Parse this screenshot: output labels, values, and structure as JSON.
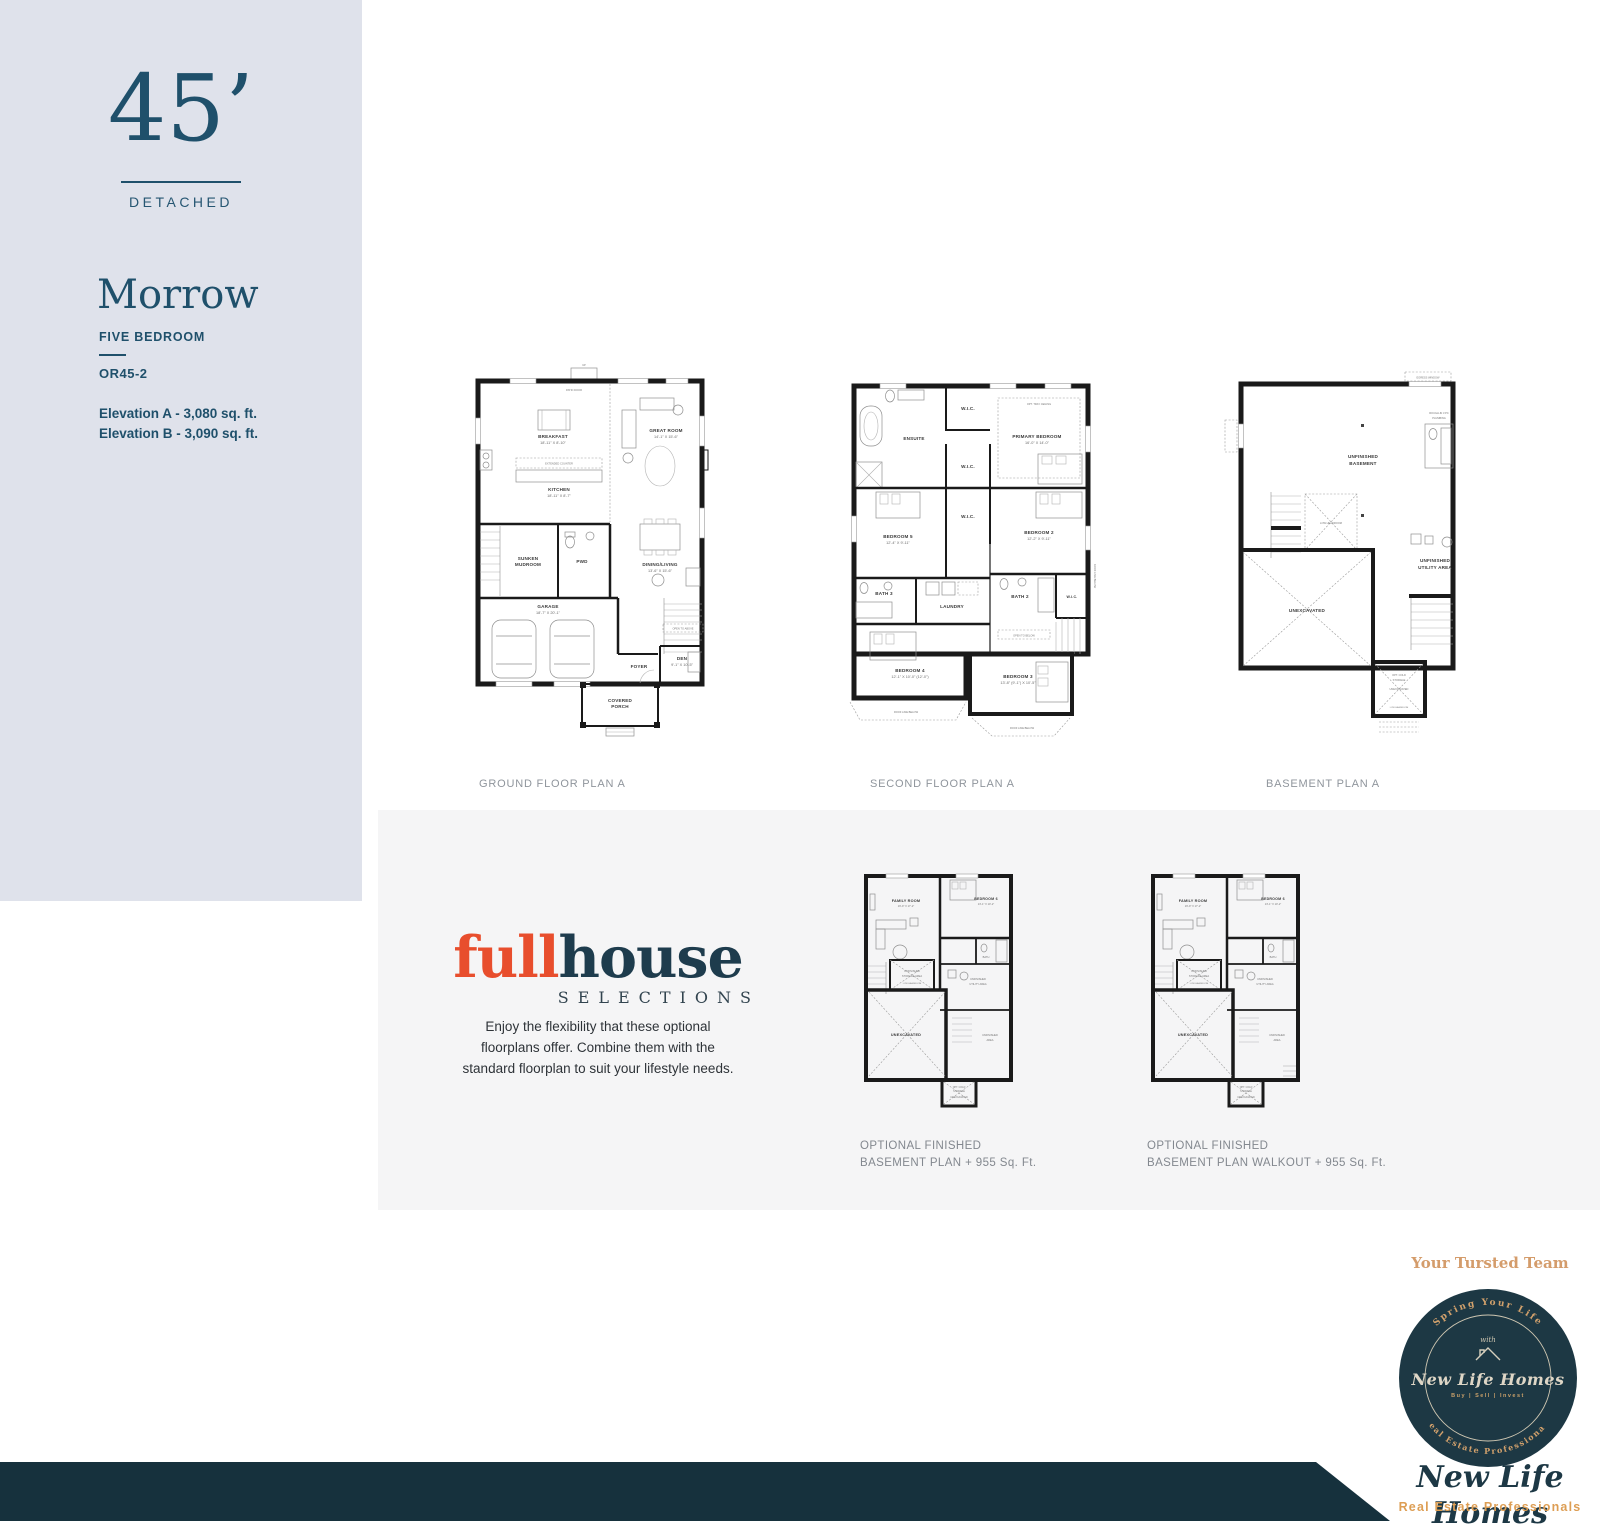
{
  "sidebar": {
    "frontage": "45’",
    "type": "DETACHED",
    "model": "Morrow",
    "bedrooms": "FIVE BEDROOM",
    "code": "OR45-2",
    "elevation_a": "Elevation A - 3,080 sq. ft.",
    "elevation_b": "Elevation B - 3,090 sq. ft.",
    "bg_color": "#dfe2eb",
    "accent_color": "#1f506b"
  },
  "captions": {
    "ground": "GROUND FLOOR PLAN A",
    "second": "SECOND FLOOR PLAN A",
    "basement": "BASEMENT PLAN A",
    "optional_left": [
      "OPTIONAL FINISHED",
      "BASEMENT PLAN + 955 Sq. Ft."
    ],
    "optional_right": [
      "OPTIONAL FINISHED",
      "BASEMENT PLAN WALKOUT + 955 Sq. Ft."
    ]
  },
  "ground": {
    "up": "UP",
    "patio_door": "PATIO DOOR",
    "breakfast": "BREAKFAST",
    "breakfast_dim": "18'-11\" X 8'-10\"",
    "kitchen": "KITCHEN",
    "kitchen_dim": "18'-11\" X 8'-7\"",
    "extended_counter": "EXTENDED COUNTER",
    "great_room": "GREAT ROOM",
    "great_room_dim": "14'-1\" X 15'-6\"",
    "sunken": "SUNKEN",
    "mudroom": "MUDROOM",
    "pwd": "PWD",
    "dining": "DINING/LIVING",
    "dining_dim": "13'-6\" X 15'-6\"",
    "garage": "GARAGE",
    "garage_dim": "18'-7\" X 20'-1\"",
    "open_above": "OPEN TO ABOVE",
    "foyer": "FOYER",
    "den": "DEN",
    "den_dim": "9'-1\" X 10'-5\"",
    "covered": "COVERED",
    "porch": "PORCH"
  },
  "second": {
    "ensuite": "ENSUITE",
    "wic": "W.I.C.",
    "primary": "PRIMARY BEDROOM",
    "primary_dim": "16'-0\" X 14'-0\"",
    "tray": "OPT. TRAY CEILING",
    "bedroom5": "BEDROOM 5",
    "bedroom5_dim": "12'-4\" X 9'-11\"",
    "bedroom2": "BEDROOM 2",
    "bedroom2_dim": "12'-2\" X 9'-11\"",
    "bath3": "BATH 3",
    "laundry": "LAUNDRY",
    "bath2": "BATH 2",
    "bedroom4": "BEDROOM 4",
    "bedroom4_dim": "12'-1\" X 10'-0\" (12'-0\")",
    "bedroom3": "BEDROOM 3",
    "bedroom3_dim": "13'-8\" (9'-1\") X 10'-5\"",
    "open_below": "OPEN TO BELOW",
    "roof_line": "ROOF LINE BELOW"
  },
  "basement": {
    "egress": "EGRESS WINDOW",
    "unfinished": "UNFINISHED",
    "basement_word": "BASEMENT",
    "low_headroom": "LOW HEADROOM",
    "unexcavated": "UNEXCAVATED",
    "utility_1": "UNFINISHED",
    "utility_2": "UTILITY AREA",
    "rough_in_1": "ROUGH-IN 3 PC",
    "rough_in_2": "PLUMBING",
    "cold_1": "OPT. COLD",
    "cold_2": "STORAGE"
  },
  "optional": {
    "family": "FAMILY ROOM",
    "family_dim": "16'-9\" X 17'-2\"",
    "bedroom6": "BEDROOM 6",
    "bedroom6_dim": "13'-1\" X 10'-2\"",
    "bath": "BATH",
    "storage_1": "UNFINISHED",
    "storage_2": "STORAGE AREA",
    "low_headroom": "LOW HEADROOM",
    "unexcavated": "UNEXCAVATED",
    "utility_1": "UNFINISHED",
    "utility_2": "UTILITY AREA",
    "area_1": "UNFINISHED",
    "area_2": "AREA",
    "cold_1": "OPT. COLD",
    "cold_2": "STORAGE"
  },
  "fullhouse": {
    "word_full": "full",
    "word_house": "house",
    "subtitle": "SELECTIONS",
    "description": [
      "Enjoy the flexibility that these optional",
      "floorplans offer. Combine them with the",
      "standard floorplan to suit your lifestyle needs."
    ],
    "color_full": "#e84e2d",
    "color_house": "#1e3c4d"
  },
  "branding": {
    "tagline": "Your Tursted Team",
    "arc_top": "Spring Your Life",
    "with_word": "with",
    "badge_name": "New Life Homes",
    "badge_services": "Buy | Sell | Invest",
    "arc_bottom": "Real Estate Professionals",
    "signature": "New Life Homes",
    "signature_sub": "Real Estate Professionals",
    "colors": {
      "badge_bg": "#1d3844",
      "gold": "#d2a16c",
      "navy": "#1d3845",
      "orange": "#dd9e54",
      "band": "#16313d"
    }
  }
}
